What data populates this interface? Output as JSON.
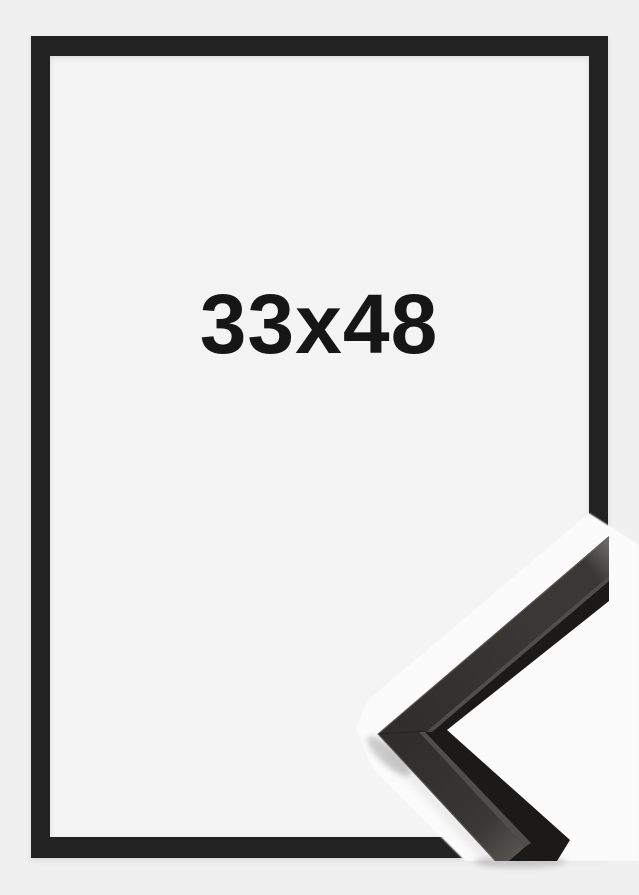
{
  "product_image": {
    "size_label": "33x48",
    "colors": {
      "background": "#f0f0f1",
      "mat": "#f4f4f5",
      "frame": "#232120",
      "label": "#161616",
      "sample_backdrop": "#fbfbfb",
      "sample_side": "#1b1a19",
      "sample_face_dark": "#2f2e2c",
      "sample_face_mid": "#3a3835",
      "sample_face_light": "#6f6d6a",
      "sample_face_end": "#5a5753",
      "sample_seam": "#57544f",
      "sample_edge_highlight": "#615e59",
      "shadow": "#9c9c9c"
    }
  }
}
